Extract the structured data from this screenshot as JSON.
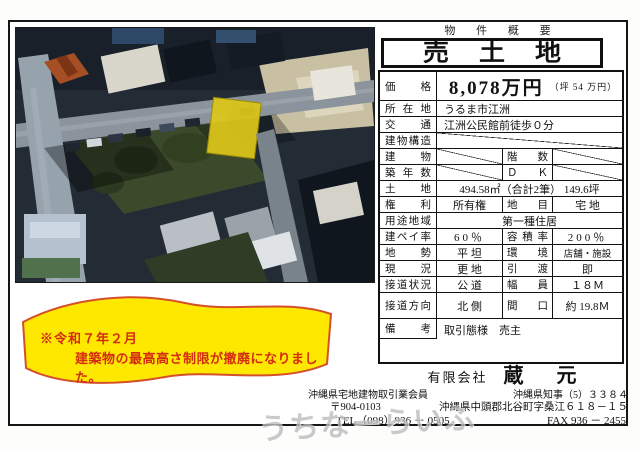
{
  "header": {
    "overview": "物 件 概 要",
    "title": "売土地"
  },
  "table": {
    "price": {
      "label": "価格",
      "value": "8,078万円",
      "sub": "（坪 54 万円）"
    },
    "location": {
      "label": "所在地",
      "value": "うるま市江洲"
    },
    "access": {
      "label": "交通",
      "value": "江洲公民館前徒歩０分"
    },
    "structure": {
      "label": "建物構造"
    },
    "building": {
      "label": "建物",
      "label2": "階数"
    },
    "age": {
      "label": "築年数",
      "label2": "Ｄ Ｋ"
    },
    "land": {
      "label": "土地",
      "value": "494.58㎡（合計2筆） 149.6坪"
    },
    "rights": {
      "label": "権利",
      "value": "所有権",
      "label2": "地目",
      "value2": "宅 地"
    },
    "zoning": {
      "label": "用途地域",
      "value": "第一種住居"
    },
    "coverage": {
      "label": "建ペイ率",
      "value": "60％",
      "label2": "容積率",
      "value2": "200％"
    },
    "terrain": {
      "label": "地勢",
      "value": "平 坦",
      "label2": "環境",
      "value2": "店舗・施設"
    },
    "current": {
      "label": "現況",
      "value": "更 地",
      "label2": "引渡",
      "value2": "即"
    },
    "road": {
      "label": "接道状況",
      "value": "公 道",
      "label2": "幅員",
      "value2": "１８Ｍ"
    },
    "road_dir": {
      "label": "接道方向",
      "value": "北 側",
      "label2": "間口",
      "value2": "約 19.8Ｍ"
    },
    "remarks": {
      "label": "備考",
      "value": "取引態様　売主"
    }
  },
  "notice": {
    "line1": "※令和７年２月",
    "line2": "建築物の最高高さ制限が撤廃になりました。"
  },
  "company": {
    "prefix": "有限会社",
    "name": "蔵 元",
    "membership": "沖縄県宅地建物取引業会員",
    "license": "沖縄県知事（5）３３８４",
    "postal": "〒904-0103",
    "address": "沖縄県中頭郡北谷町字桑江６１８－１５",
    "tel": "TEL（098）936 － 0505",
    "fax": "FAX 936 － 2455"
  },
  "watermark": "うちなーらいふ",
  "colors": {
    "notice_bg": "#ffe800",
    "notice_border": "#d4502a",
    "notice_text": "#d42c10",
    "parcel_highlight": "#d9c41a",
    "table_border": "#111111"
  }
}
